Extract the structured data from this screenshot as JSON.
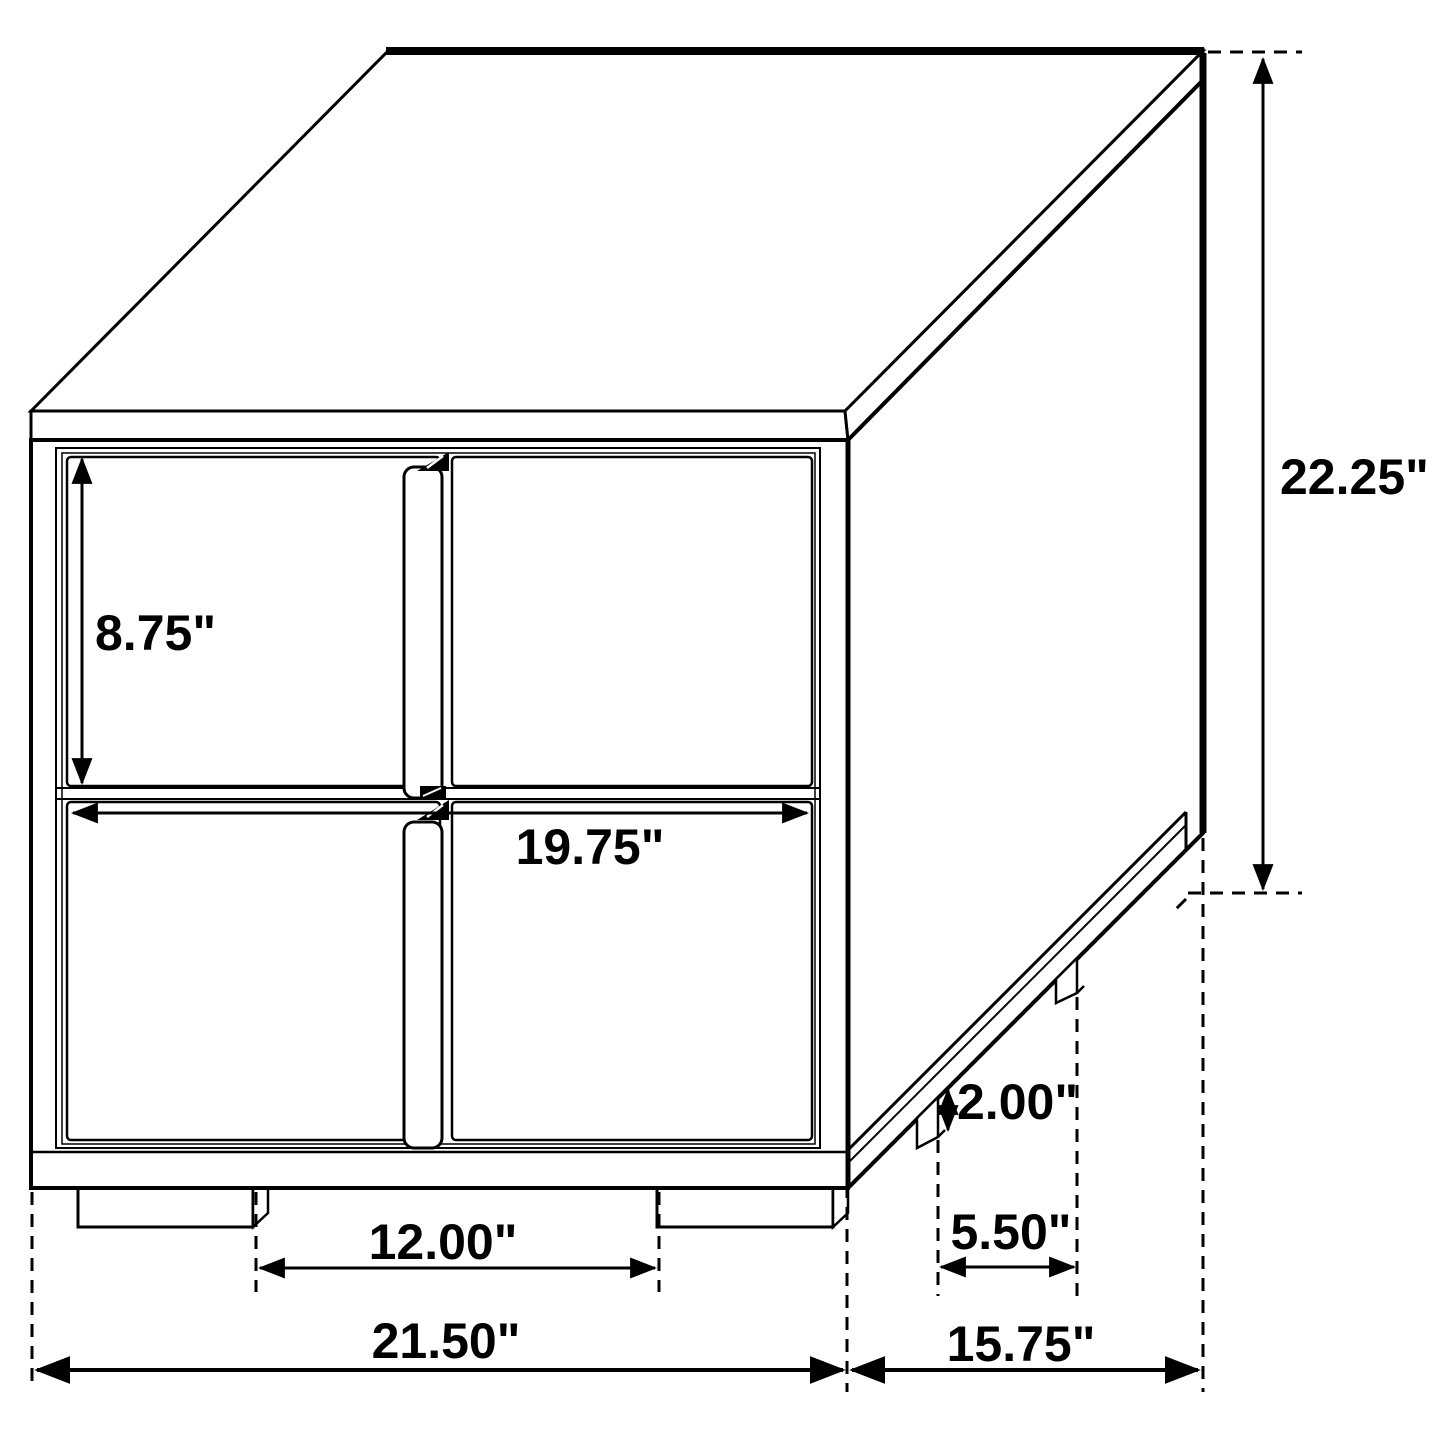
{
  "diagram": {
    "type": "furniture-dimension-drawing",
    "subject": "two-drawer nightstand, isometric line drawing with dimension callouts",
    "units": "inches",
    "background_color": "#ffffff",
    "line_color": "#000000",
    "labels": {
      "drawer_face_height": "8.75\"",
      "drawer_opening_width": "19.75\"",
      "overall_height": "22.25\"",
      "foot_height": "2.00\"",
      "side_foot_spacing": "5.50\"",
      "front_foot_spacing": "12.00\"",
      "overall_width": "21.50\"",
      "overall_depth": "15.75\""
    },
    "values_in": {
      "drawer_face_height": 8.75,
      "drawer_opening_width": 19.75,
      "overall_height": 22.25,
      "foot_height": 2.0,
      "side_foot_spacing": 5.5,
      "front_foot_spacing": 12.0,
      "overall_width": 21.5,
      "overall_depth": 15.75
    }
  }
}
